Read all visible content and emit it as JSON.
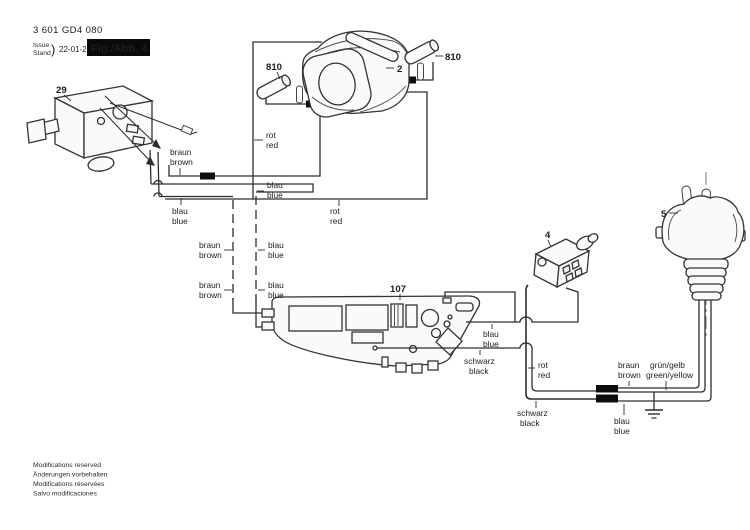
{
  "title_block": {
    "part_number": "3 601 GD4 080",
    "issue_en": "Issue",
    "issue_de": "Stand",
    "date": "22-01-26",
    "figure": "Fig./Abb. 4"
  },
  "part_labels": {
    "switch": "29",
    "stator": "2",
    "terminal_left": "810",
    "terminal_right": "810",
    "electronics": "107",
    "connector": "4",
    "plug": "5"
  },
  "wire_colors": {
    "braun": {
      "de": "braun",
      "en": "brown"
    },
    "blau": {
      "de": "blau",
      "en": "blue"
    },
    "rot": {
      "de": "rot",
      "en": "red"
    },
    "schwarz": {
      "de": "schwarz",
      "en": "black"
    },
    "gruen": {
      "de": "grün/gelb",
      "en": "green/yellow"
    }
  },
  "footer": {
    "l1": "Modifications reserved",
    "l2": "Änderungen vorbehalten",
    "l3": "Modifications réservées",
    "l4": "Salvo modificaciones"
  }
}
